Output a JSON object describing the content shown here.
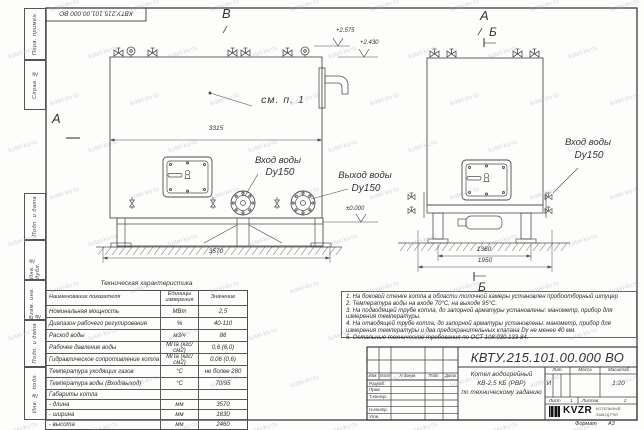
{
  "watermark": {
    "text": "kotel-kv.ru"
  },
  "frame": {
    "stamp_top": "КВТУ.215.101.00.000 ВО",
    "side_labels": [
      "Перв. примен.",
      "Справ. №",
      "Подп. и дата",
      "Инв. № дубл.",
      "Взам. инв. №",
      "Подп. и дата",
      "Инв. № подл."
    ],
    "format_label": "Формат",
    "format_value": "А3"
  },
  "drawing": {
    "view_markers": {
      "a_left": "А",
      "b_top": "В",
      "a_right": "А",
      "b_right": "Б",
      "b_bottom": "Б"
    },
    "labels": {
      "see_note": "см. п. 1",
      "inlet_left_1": "Вход воды",
      "inlet_left_2": "Dy150",
      "outlet_left_1": "Выход воды",
      "outlet_left_2": "Dy150",
      "inlet_right_1": "Вход воды",
      "inlet_right_2": "Dy150"
    },
    "dimensions": {
      "inner_width": "3315",
      "length": "3570",
      "support_span": "1360",
      "depth": "1950"
    },
    "elevations": {
      "top1": "+2.575",
      "top2": "+2.430",
      "ground": "±0.000"
    }
  },
  "spec_table": {
    "title": "Техническая характеристика",
    "headers": [
      "Наименование показателя",
      "Единицы измерения",
      "Значение"
    ],
    "rows": [
      [
        "Номинальная мощность",
        "МВт",
        "2,5"
      ],
      [
        "Диапазон рабочего регулирования",
        "%",
        "40-110"
      ],
      [
        "Расход воды",
        "м3/ч",
        "86"
      ],
      [
        "Рабочее давление воды",
        "МПа (кгс/см2)",
        "0,6 (6,0)"
      ],
      [
        "Гидравлическое сопротивление котла",
        "МПа (кгс/см2)",
        "0,06 (0,6)"
      ],
      [
        "Температура уходящих газов",
        "°С",
        "не более 280"
      ],
      [
        "Температура воды (Вход/выход)",
        "°С",
        "70/95"
      ],
      [
        "Габариты котла",
        "",
        ""
      ],
      [
        "- длина",
        "мм",
        "3570"
      ],
      [
        "- ширина",
        "мм",
        "1830"
      ],
      [
        "- высота",
        "мм",
        "2460"
      ]
    ]
  },
  "notes": [
    "1.  На боковой стенке котла в области топочной камеры установлен пробоотборный штуцер",
    "2.  Температура воды на входе 70°С, на выходе 95°С.",
    "3.  На подводящей трубе котла, до запорной арматуры установлены: манометр, прибор для измерения температуры.",
    "4.  На отводящей трубе котла, до запорной арматуры установлены: манометр, прибор для измерения температуры и два предохранительных клапана Dy не менее 40 мм.",
    "5.  Остальные технические требования по ОСТ 108.030.133-84."
  ],
  "title_block": {
    "designation": "КВТУ.215.101.00.000 ВО",
    "header_cols": [
      "Изм.",
      "Лист",
      "N докум.",
      "Подп.",
      "Дата"
    ],
    "roles": [
      "Разраб.",
      "Пров.",
      "Т.контр.",
      "",
      "Н.контр.",
      "Утв."
    ],
    "name_line1": "Котел водогрейный",
    "name_line2": "КВ-2,5 КБ (РВР)",
    "name_line3": "по техническому заданию",
    "lit_label": "Лит.",
    "mass_label": "Масса",
    "scale_label": "Масштаб",
    "lit_value": "И",
    "scale_value": "1:20",
    "sheet_label": "Лист",
    "sheet_value": "1",
    "sheets_label": "Листов",
    "sheets_value": "2",
    "company": {
      "logo": "KVZR",
      "name_line1": "КОТЕЛЬНЫЙ",
      "name_line2": "ЗАВОД РЭП"
    }
  }
}
